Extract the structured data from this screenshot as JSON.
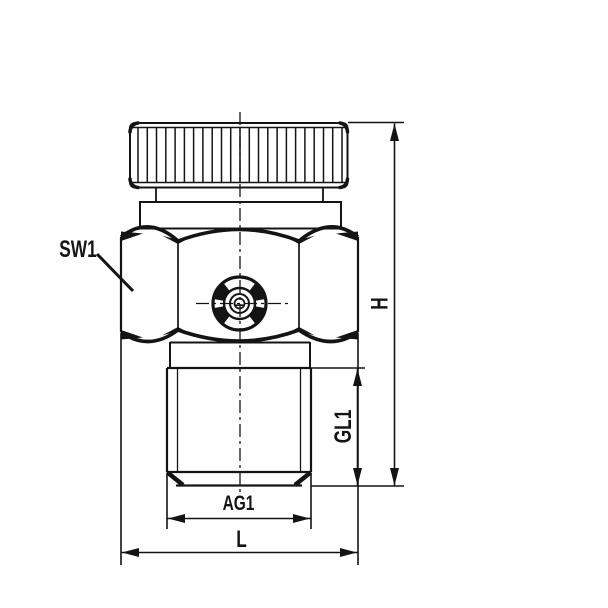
{
  "figure": {
    "background": "#ffffff",
    "line_color": "#141414",
    "labels": {
      "sw1": "SW1",
      "h": "H",
      "gl1": "GL1",
      "ag1": "AG1",
      "l": "L"
    }
  }
}
